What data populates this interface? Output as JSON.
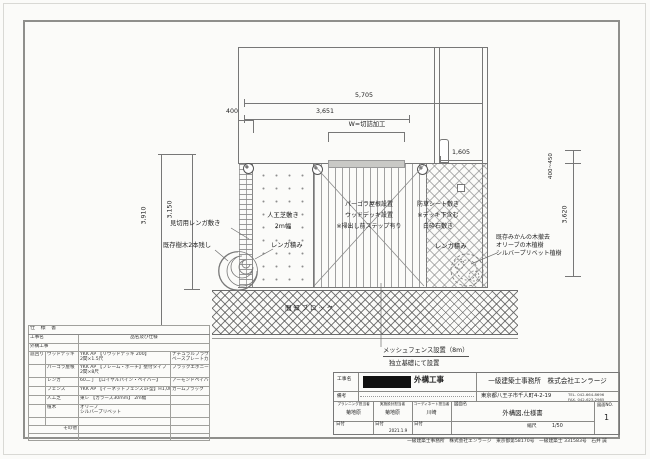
{
  "drawing": {
    "dimensions": {
      "width_total": "5,705",
      "width_deck": "3,651",
      "cut_note": "W=切詰加工",
      "offset_left": "400",
      "gap_right": "1,605",
      "depth_outer": "3,910",
      "depth_inner": "3,150",
      "range_right": "400~450",
      "depth_right": "3,620"
    },
    "annotations": {
      "edge_brick": "見切用レンガ敷き",
      "keep_trees": "既存樹木2本残し",
      "turf1": "人工芝敷き",
      "turf2": "2m幅",
      "brick_stack_left": "レンガ積み",
      "deck1": "パーゴラ屋根設置",
      "deck2": "ウッドデッキ設置",
      "deck3": "※掃出し前ステップ有り",
      "gravel1": "防草シート敷き",
      "gravel2": "※デッキ下含む",
      "gravel3": "白砕石敷き",
      "brick_stack_right": "レンガ積み",
      "plant1": "既存みかんの木撤去",
      "plant2": "オリーブの木植樹",
      "plant3": "シルバープリベット植樹",
      "kenchi": "間知ブロック",
      "mesh1": "メッシュフェンス設置（8m）",
      "mesh2": "独立基礎にて設置"
    }
  },
  "spec_table": {
    "title": "仕 様 書",
    "col_project": "工事名",
    "col_item": "品名及び仕様",
    "project": "外構工事",
    "group": "庭回り",
    "rows": [
      {
        "item": "ウッドデッキ",
        "spec1": "YKK AP 【リウッドデッキ 200】",
        "spec2": "2間×1.5尺",
        "color1": "ナチュラルブラウン",
        "color2": "ベースプレートカバー"
      },
      {
        "item": "パーゴラ屋根",
        "spec1": "YKK AP 【フレーム・ポーチ】壁付タイプ",
        "spec2": "2間×8尺",
        "color1": "ブラックエボニー",
        "color2": ""
      },
      {
        "item": "レンガ",
        "spec1": "60二丁 【ロイヤルパイン・ペイバー】",
        "spec2": "",
        "color1": "アーモンドペイバー",
        "color2": ""
      },
      {
        "item": "フェンス",
        "spec1": "YKK AP 【イーネットフェンス1F型】H1,000",
        "spec2": "",
        "color1": "カームブラック",
        "color2": ""
      },
      {
        "item": "人工芝",
        "spec1": "東レ 【カラーズ30mm】 2m幅",
        "spec2": "",
        "color1": "",
        "color2": ""
      },
      {
        "item": "植木",
        "spec1": "オリーブ",
        "spec2": "シルバープリベット",
        "color1": "",
        "color2": ""
      },
      {
        "item": "その他",
        "spec1": "",
        "spec2": "",
        "color1": "",
        "color2": ""
      }
    ]
  },
  "title_block": {
    "project_label": "工事名",
    "project_name": "外構工事",
    "remarks_label": "備考",
    "company": "一級建築士事務所　株式会社エンラージ",
    "address": "東京都八王子市千人町4-2-19",
    "tel": "TEL. 042-664-8696",
    "fax": "FAX. 042-623-2985",
    "staff": [
      {
        "role": "プランニング担当者",
        "name": "菊地原"
      },
      {
        "role": "実施設計担当者",
        "name": "菊地原"
      },
      {
        "role": "コーディネート担当者",
        "name": "川崎"
      }
    ],
    "date_label": "日付",
    "date_value": "2021.1.9",
    "dwg_label": "図面名",
    "dwg_name": "外構図,仕様書",
    "scale_label": "縮尺",
    "scale_value": "1/50",
    "no_label": "図面NO.",
    "no_value": "1",
    "footer": "一級建築士事務所　株式会社エンラージ　東京都第58170号　一級建築士 331583号　石井 誠"
  }
}
